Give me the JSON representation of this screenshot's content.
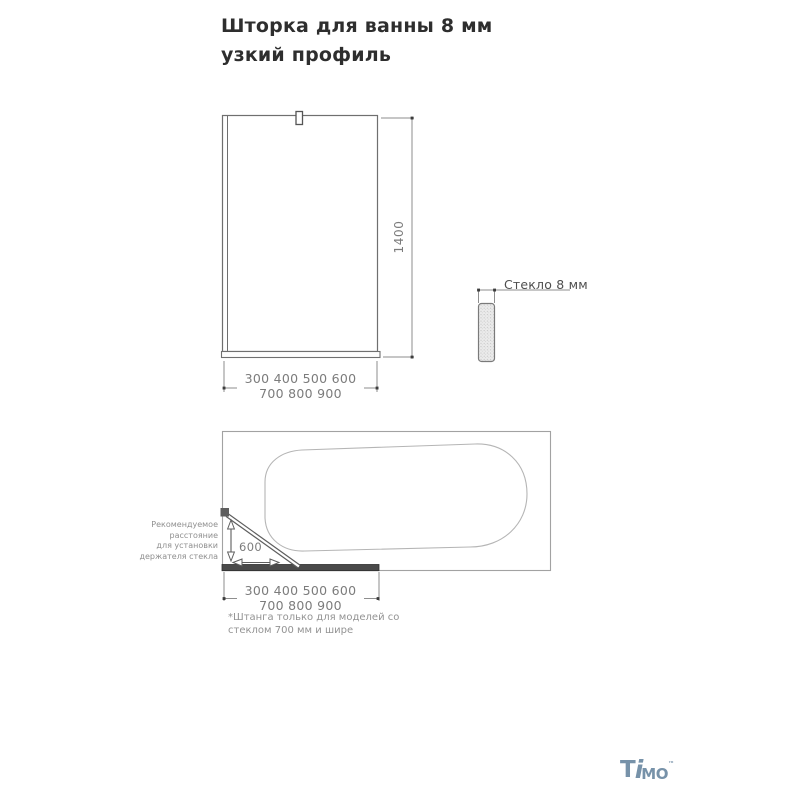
{
  "title": "Шторка для ванны 8 мм узкий профиль",
  "front_view": {
    "height_dim": "1400",
    "width_dims_line1": "300 400 500 600",
    "width_dims_line2": "700 800 900"
  },
  "glass_detail": {
    "label": "Стекло 8 мм"
  },
  "top_view": {
    "holder_note": [
      "Рекомендуемое",
      "расстояние",
      "для установки",
      "держателя стекла"
    ],
    "rod_distance": "600",
    "width_dims_line1": "300 400 500 600",
    "width_dims_line2": "700 800 900",
    "footnote": [
      "*Штанга только для моделей со",
      "стеклом 700 мм и шире"
    ]
  },
  "logo": {
    "part_t": "T",
    "part_i": "i",
    "part_mo": "MO",
    "trademark": "™"
  },
  "colors": {
    "logo_accent": "#7792a9",
    "drawing_line": "#8e8e8e",
    "screen_bar": "#4a4a4a",
    "title_text": "#2e2e2e",
    "dim_text": "#7c7c7c"
  }
}
